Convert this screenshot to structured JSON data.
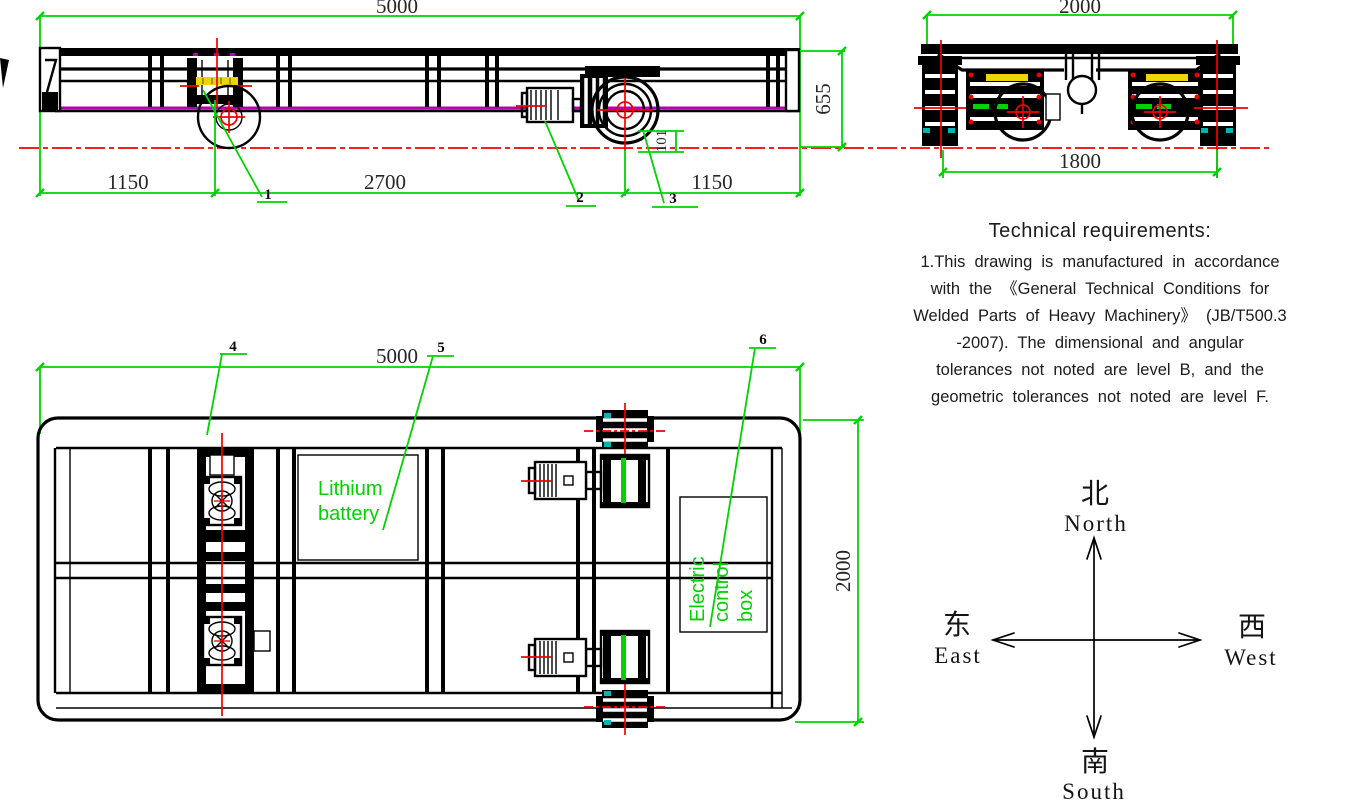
{
  "colors": {
    "green": "#00d300",
    "red": "#f00000",
    "magenta": "#b400b4",
    "yellow": "#eed400",
    "cyan": "#00b4b4"
  },
  "side_view": {
    "dim_overall_length": "5000",
    "dim_front_overhang": "1150",
    "dim_wheelbase": "2700",
    "dim_rear_overhang": "1150",
    "dim_height": "655",
    "dim_wheel_to_rail": "101",
    "callout_1": "1",
    "callout_2": "2",
    "callout_3": "3"
  },
  "end_view": {
    "dim_overall_width": "2000",
    "dim_track_gauge": "1800"
  },
  "plan_view": {
    "dim_overall_length": "5000",
    "dim_overall_width": "2000",
    "battery_label_line1": "Lithium",
    "battery_label_line2": "battery",
    "control_box_line1": "Electric",
    "control_box_line2": "control",
    "control_box_line3": "box",
    "callout_4": "4",
    "callout_5": "5",
    "callout_6": "6"
  },
  "tech_requirements": {
    "title": "Technical requirements:",
    "lines": [
      "1.This drawing is manufactured in accordance",
      "with the 《General Technical Conditions for",
      "Welded Parts of Heavy Machinery》 (JB/T500.3",
      "-2007). The dimensional and angular",
      "tolerances not noted are level B, and the",
      "geometric tolerances not noted are level F."
    ]
  },
  "compass": {
    "north_cn": "北",
    "north_en": "North",
    "south_cn": "南",
    "south_en": "South",
    "east_cn": "东",
    "east_en": "East",
    "west_cn": "西",
    "west_en": "West"
  }
}
